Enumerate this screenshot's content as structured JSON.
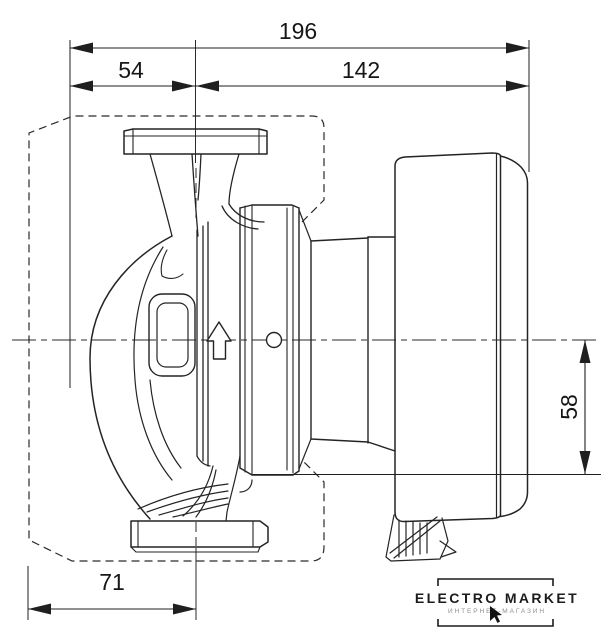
{
  "dimensions": {
    "overall_length": "196",
    "left_section": "54",
    "right_section": "142",
    "bottom_offset": "71",
    "vertical_offset": "58"
  },
  "watermark": {
    "brand": "ELECTRO MARKET",
    "tagline": "ИНТЕРНЕТ-МАГАЗИН"
  },
  "colors": {
    "line": "#242424",
    "dim_line": "#1f1f1f",
    "background": "#ffffff",
    "tagline": "#8f8f8f"
  }
}
